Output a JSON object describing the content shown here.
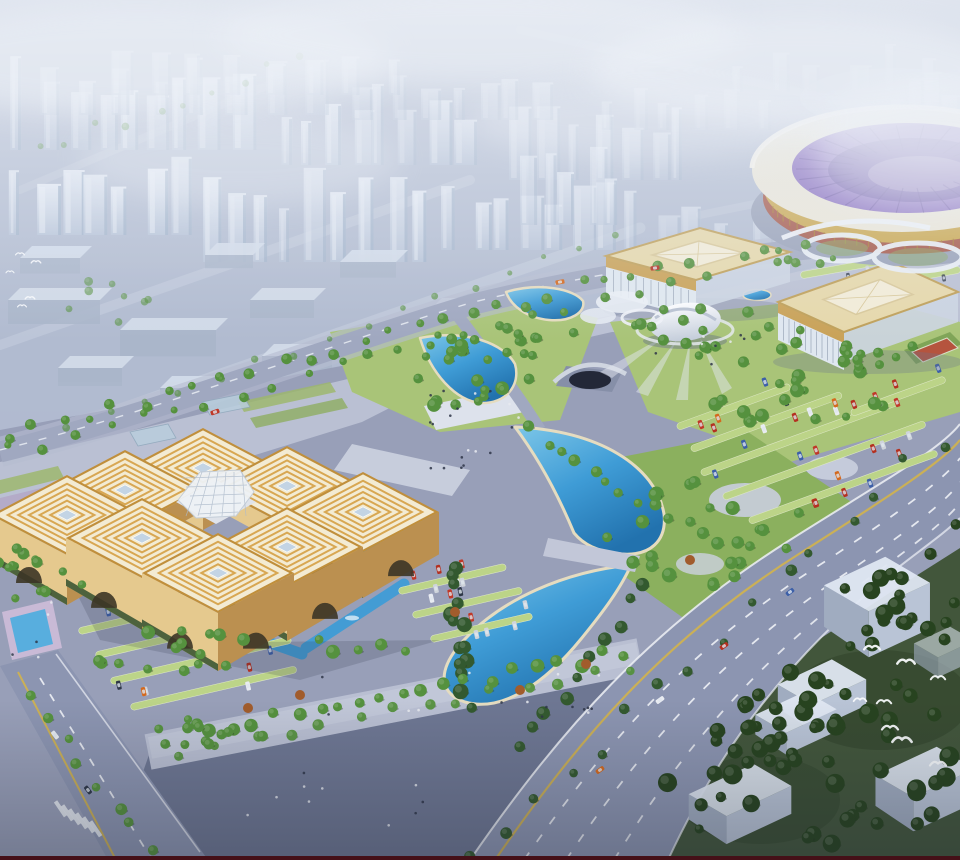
{
  "scene": {
    "kind": "architectural-aerial-rendering",
    "features": [
      "hazy-city-skyline",
      "stadium",
      "exhibition-hall-north",
      "exhibition-hall-east",
      "egg-pavilion",
      "convention-complex-eight-pavilions",
      "central-glass-dome",
      "crescent-lake-upper",
      "crescent-lake-lower",
      "fan-ponds",
      "reflecting-pools",
      "parks",
      "parking-lots",
      "grand-avenue",
      "promenade",
      "forest-southeast",
      "warehouse-boxes",
      "bird-flocks"
    ]
  },
  "palette": {
    "sky_top": "#cbd3e3",
    "sky_bottom": "#a8b2c9",
    "fog": "#edf1f8",
    "city_ground": "#b0bacf",
    "city_street": "#c7cfdf",
    "tower_face": "#dce4f0",
    "tower_side": "#9db0c8",
    "lowrise_top": "#d3dcea",
    "lowrise_front": "#aab6ca",
    "site_base": "#989fb8",
    "plaza_light": "#bfc5d7",
    "plaza_dark": "#6e7793",
    "promenade": "#b9bfd2",
    "white_plaza": "#dde2ec",
    "road": "#a0a8c0",
    "road_major": "#8c95b1",
    "lane_white": "#eef1f6",
    "lane_yellow": "#d2b24c",
    "green_light": "#a9c478",
    "green_mid": "#8bb05e",
    "ground_forest": "#42563b",
    "tree_light": "#7fae52",
    "tree_mid": "#55913e",
    "tree_dark": "#33592f",
    "tree_forest": "#27431f",
    "tree_red": "#a15c2c",
    "water_light": "#7cc6e8",
    "water_main": "#3f9cd6",
    "water_deep": "#2272ae",
    "water_edge": "#e5dcc0",
    "roof_cream": "#f3ebd3",
    "roof_stripe": "#d8a752",
    "roof_trim": "#c08f3c",
    "skylight": "#c3d4e4",
    "gold_light": "#e5c98e",
    "gold_dark": "#bb9050",
    "arch_dark": "#3c3526",
    "soffit": "#33502f",
    "dome_glass": "#eef2f6",
    "dome_line": "#aebbcb",
    "hall_roof": "#e6d8ab",
    "hall_skylight": "#f2ecd8",
    "hall_gold": "#c9a258",
    "hall_glass": "#dfe7f0",
    "stadium_roof": "#eae6d8",
    "stadium_purple": "#8a70c0",
    "stadium_purple_dark": "#6c55a8",
    "stadium_gold": "#caa851",
    "stadium_red": "#a4584a",
    "stadium_base": "#98a1b8",
    "egg_white": "#f2f4f8",
    "canopy_white": "#eaeef5",
    "box_top": "#dfe7f2",
    "box_front": "#b9c4d6",
    "box_side": "#a0acc0",
    "stall_green": "#bcd488",
    "court_red": "#b5543e",
    "car_colors": [
      "#c03828",
      "#d4691e",
      "#e9ecf2",
      "#2e3748",
      "#3c5fa8",
      "#b43020",
      "#cfd4dc"
    ],
    "people": "#2e3548",
    "bird": "#f8fafc",
    "pool_deck": "#c9bad6",
    "maroon": "#451018"
  },
  "counts": {
    "city_towers": 96,
    "low_rise_blocks": 10,
    "trees": 360,
    "parked_cars": 84,
    "road_cars": 9,
    "birds_right": 8,
    "birds_left": 5,
    "people": 60,
    "pavilions": 8,
    "exhibition_halls": 2,
    "warehouse_boxes": 6
  }
}
